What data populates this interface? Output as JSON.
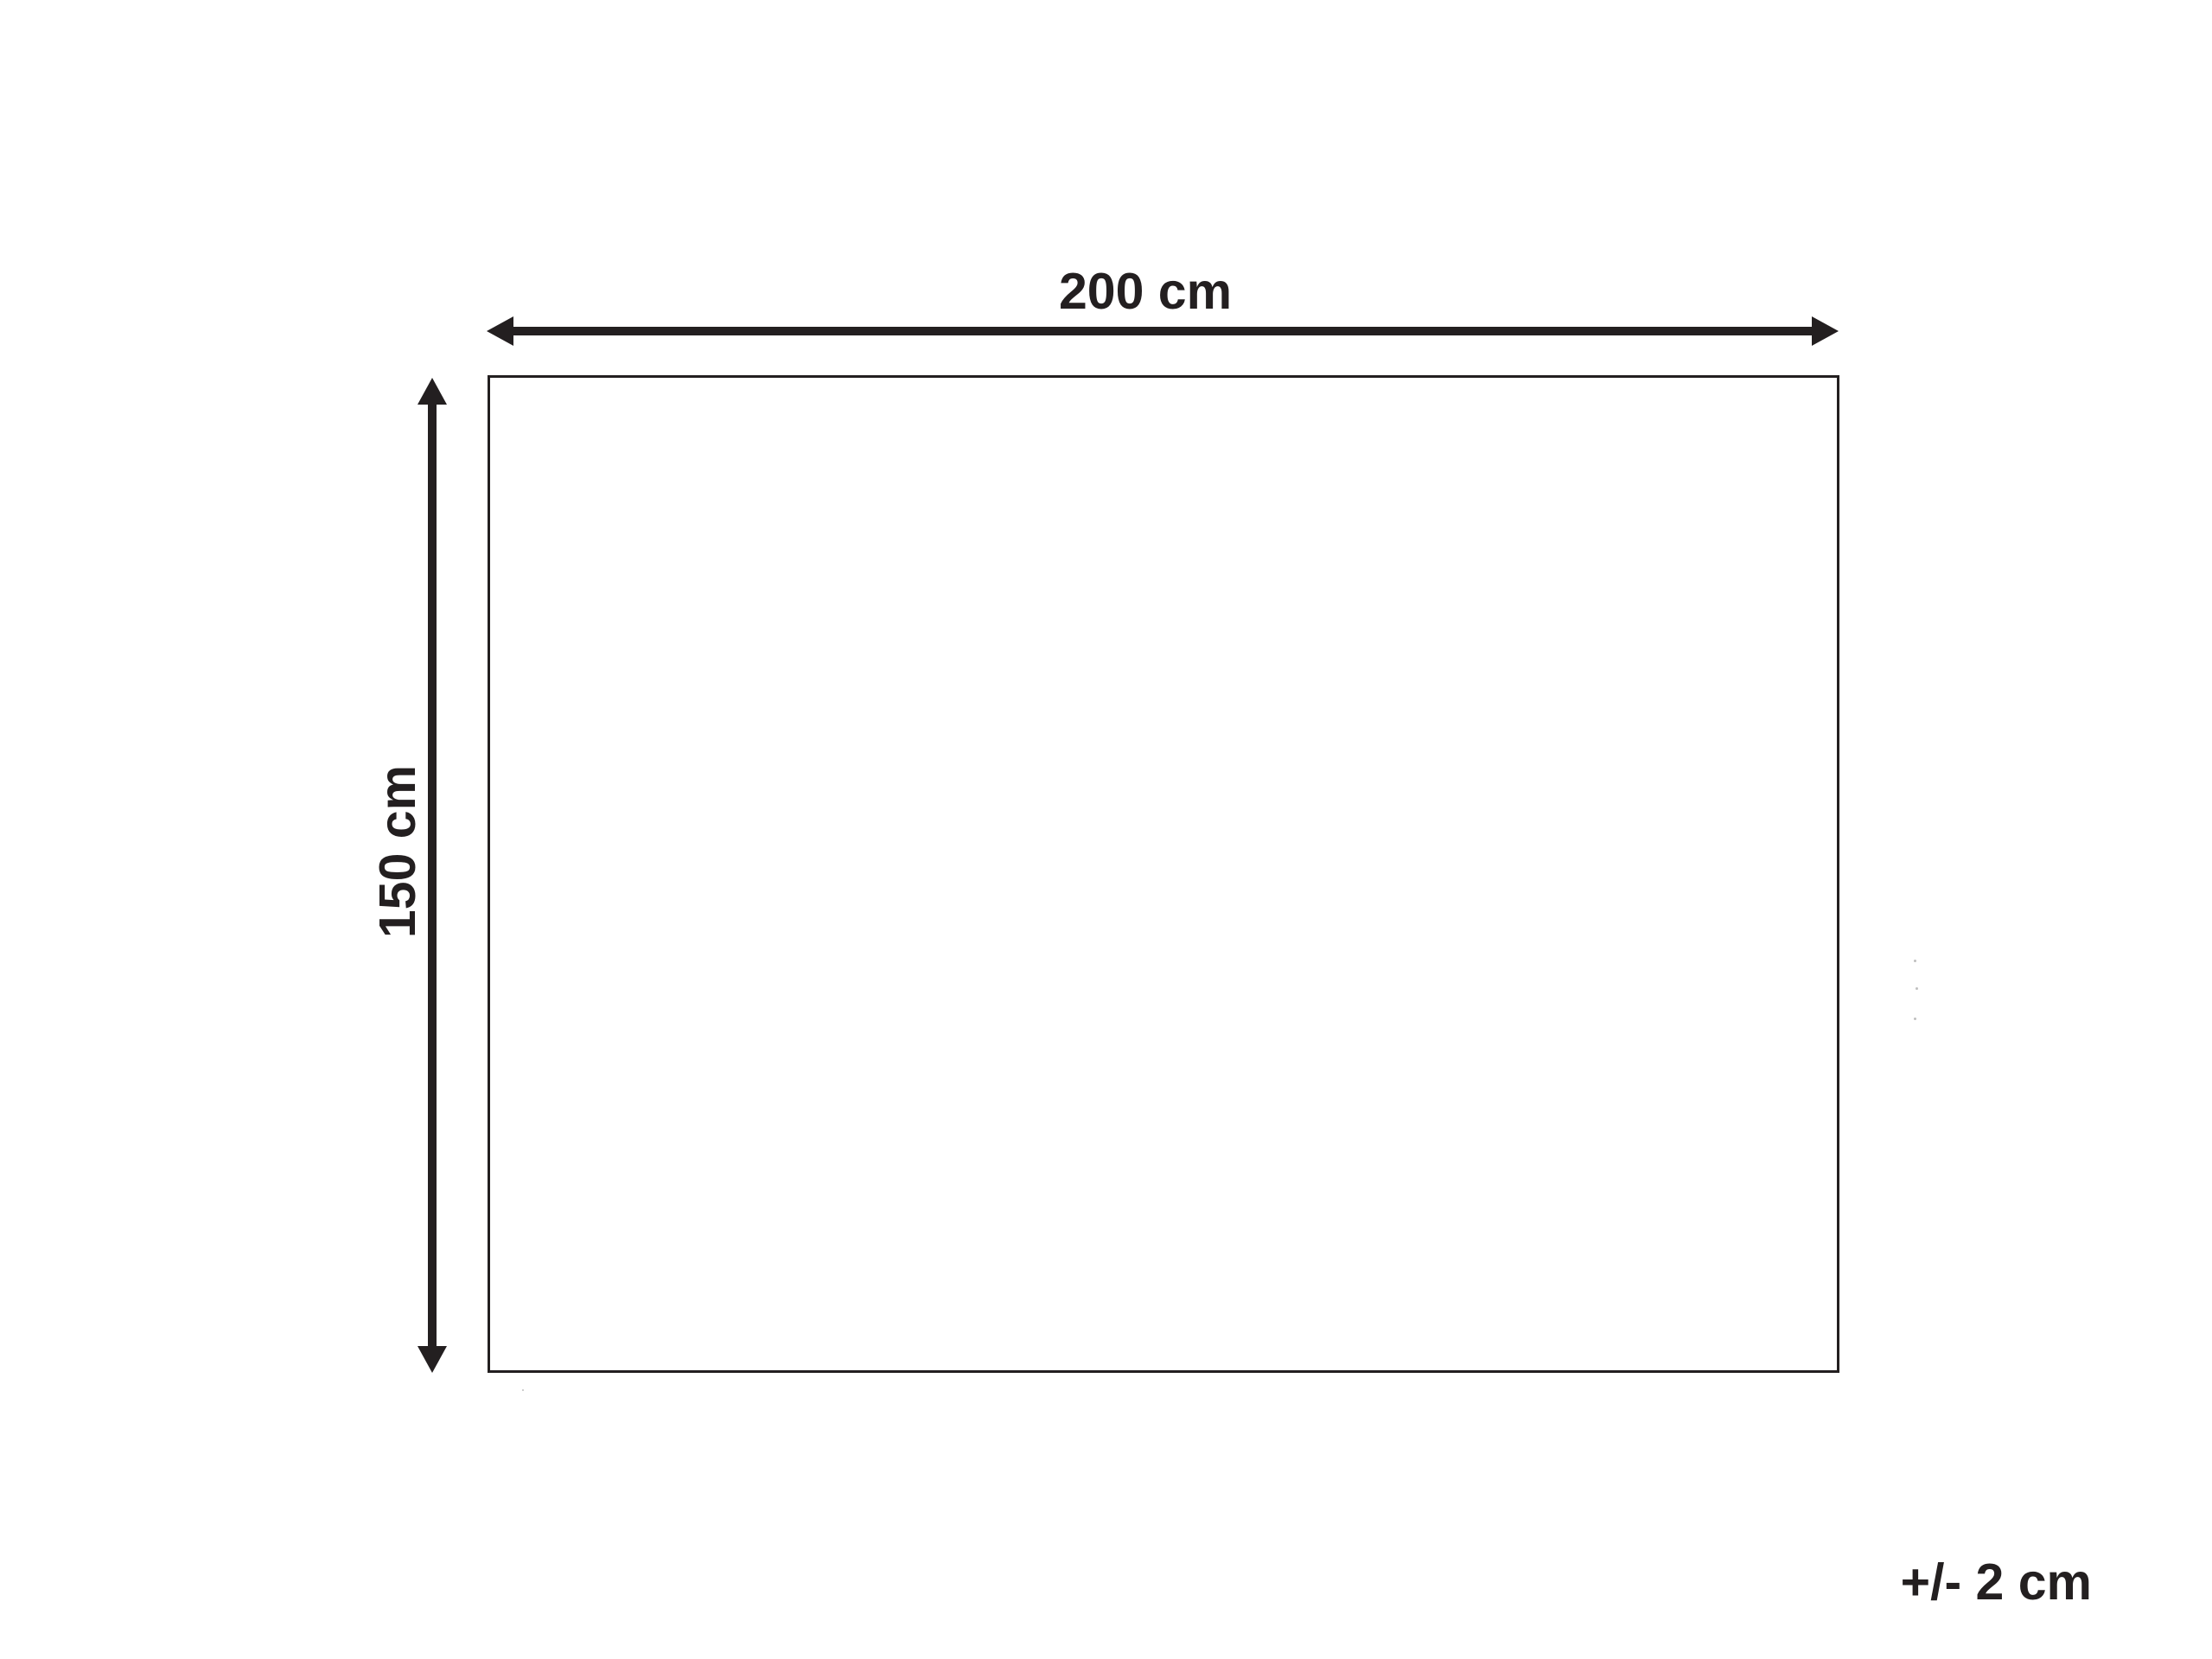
{
  "diagram": {
    "type": "product-dimension-diagram",
    "width_label": "200 cm",
    "height_label": "150 cm",
    "tolerance_label": "+/- 2 cm",
    "colors": {
      "ink": "#231f20",
      "background": "#ffffff"
    }
  }
}
